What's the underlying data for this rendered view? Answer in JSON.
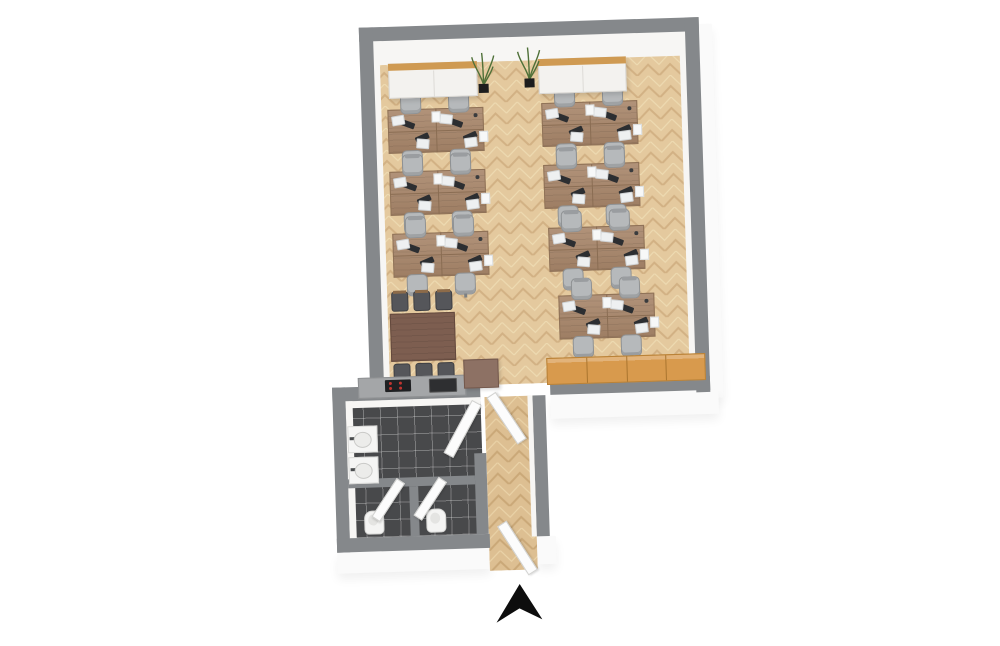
{
  "meta": {
    "title": "3D office floor plan render",
    "view": "top-down 3d",
    "rotation_deg": -1.8
  },
  "palette": {
    "background": "#ffffff",
    "wall_gray": "#85888b",
    "wood_floor_base": "#e4c99e",
    "wood_floor_line": "#d2b184",
    "desk_wood": "#a8866a",
    "meeting_table_wood": "#7d5e50",
    "chair_gray": "#b6b9bb",
    "monitor_dark": "#2c2e31",
    "cabinet_white": "#f3f2ef",
    "cabinet_top_wood": "#cf9a52",
    "locker_orange": "#d89a4d",
    "tile_dark": "#48494b",
    "fixture_white": "#f5f5f4",
    "fridge_brown": "#8d7164",
    "arrow_black": "#0d0d0d"
  },
  "rooms": [
    {
      "id": "open-office",
      "floor": "herringbone-oak"
    },
    {
      "id": "restroom",
      "floor": "dark-tile"
    },
    {
      "id": "entrance-corridor",
      "floor": "herringbone-oak"
    }
  ],
  "structure": {
    "main_room": {
      "outer": {
        "x": 368,
        "y": 23,
        "w": 340,
        "h": 375
      },
      "wall": 14,
      "inner_floor": {
        "x": 381,
        "y": 36,
        "w": 314,
        "h": 348
      },
      "bottom_gap": {
        "x1": 478,
        "x2": 548
      }
    },
    "annex": {
      "left_wall": {
        "x": 330,
        "y": 382,
        "w": 13,
        "h": 165
      },
      "bottom_wall": {
        "x": 330,
        "y": 533,
        "w": 153,
        "h": 14
      },
      "bath_floor": {
        "x": 343,
        "y": 396,
        "w": 135,
        "h": 137
      },
      "stall_divider_h": {
        "x": 343,
        "y": 474,
        "w": 127,
        "h": 9
      },
      "stall_divider_v": {
        "x": 404,
        "y": 483,
        "w": 9,
        "h": 50
      },
      "bath_corridor_wall": {
        "x": 470,
        "y": 452,
        "w": 12,
        "h": 81
      },
      "corridor_floor": {
        "x": 482,
        "y": 396,
        "w": 48,
        "h": 174
      },
      "corridor_right_wall": {
        "x": 530,
        "y": 396,
        "w": 13,
        "h": 141
      }
    }
  },
  "furniture": {
    "desk_clusters": [
      {
        "id": "desks-L1",
        "x": 394,
        "y": 106
      },
      {
        "id": "desks-L2",
        "x": 394,
        "y": 168
      },
      {
        "id": "desks-L3",
        "x": 395,
        "y": 230
      },
      {
        "id": "desks-R1",
        "x": 548,
        "y": 104
      },
      {
        "id": "desks-R2",
        "x": 548,
        "y": 166
      },
      {
        "id": "desks-R3",
        "x": 551,
        "y": 229
      },
      {
        "id": "desks-R4",
        "x": 559,
        "y": 297
      }
    ],
    "desk_cluster_spec": {
      "w": 96,
      "h": 44,
      "seats": 4
    },
    "meeting_set": {
      "x": 390,
      "y": 310,
      "w": 63,
      "h": 46,
      "chairs": 6
    },
    "sideboards": [
      {
        "id": "sideboard-left",
        "x": 396,
        "y": 60,
        "w": 87,
        "h": 33
      },
      {
        "id": "sideboard-right",
        "x": 546,
        "y": 60,
        "w": 86,
        "h": 33
      }
    ],
    "plants": [
      {
        "id": "plant-left",
        "x": 478,
        "y": 48
      },
      {
        "id": "plant-right",
        "x": 524,
        "y": 44
      }
    ],
    "lockers": {
      "x": 545,
      "y": 359,
      "w": 157,
      "h": 25,
      "count": 4
    },
    "kitchenette": {
      "counter": {
        "x": 356,
        "y": 373,
        "w": 106,
        "h": 19
      },
      "cooktop": {
        "x": 383,
        "y": 376,
        "w": 26,
        "h": 12,
        "burners": 4
      },
      "sink": {
        "x": 427,
        "y": 376,
        "w": 26,
        "h": 12
      },
      "fridge": {
        "x": 462,
        "y": 358,
        "w": 33,
        "h": 27
      }
    },
    "restroom_fixtures": {
      "sinks": [
        {
          "id": "washbasin-1",
          "x": 344,
          "y": 421
        },
        {
          "id": "washbasin-2",
          "x": 344,
          "y": 452
        }
      ],
      "toilets": [
        {
          "id": "toilet-1",
          "x": 358,
          "y": 506
        },
        {
          "id": "toilet-2",
          "x": 420,
          "y": 506
        }
      ]
    },
    "doors": [
      {
        "id": "office-door",
        "x": 484,
        "y": 397,
        "w": 9,
        "h": 54,
        "rot": -32,
        "origin": "top left"
      },
      {
        "id": "restroom-door",
        "x": 468,
        "y": 404,
        "w": 9,
        "h": 58,
        "rot": 30,
        "origin": "top right"
      },
      {
        "id": "stall-door-1",
        "x": 390,
        "y": 480,
        "w": 8,
        "h": 44,
        "rot": 35,
        "origin": "top right"
      },
      {
        "id": "stall-door-2",
        "x": 432,
        "y": 480,
        "w": 8,
        "h": 44,
        "rot": 35,
        "origin": "top right"
      },
      {
        "id": "entrance-door",
        "x": 519,
        "y": 512,
        "w": 9,
        "h": 56,
        "rot": -31,
        "origin": "bottom right"
      }
    ],
    "north_arrow": {
      "x": 487,
      "y": 584,
      "w": 46,
      "h": 38
    }
  }
}
